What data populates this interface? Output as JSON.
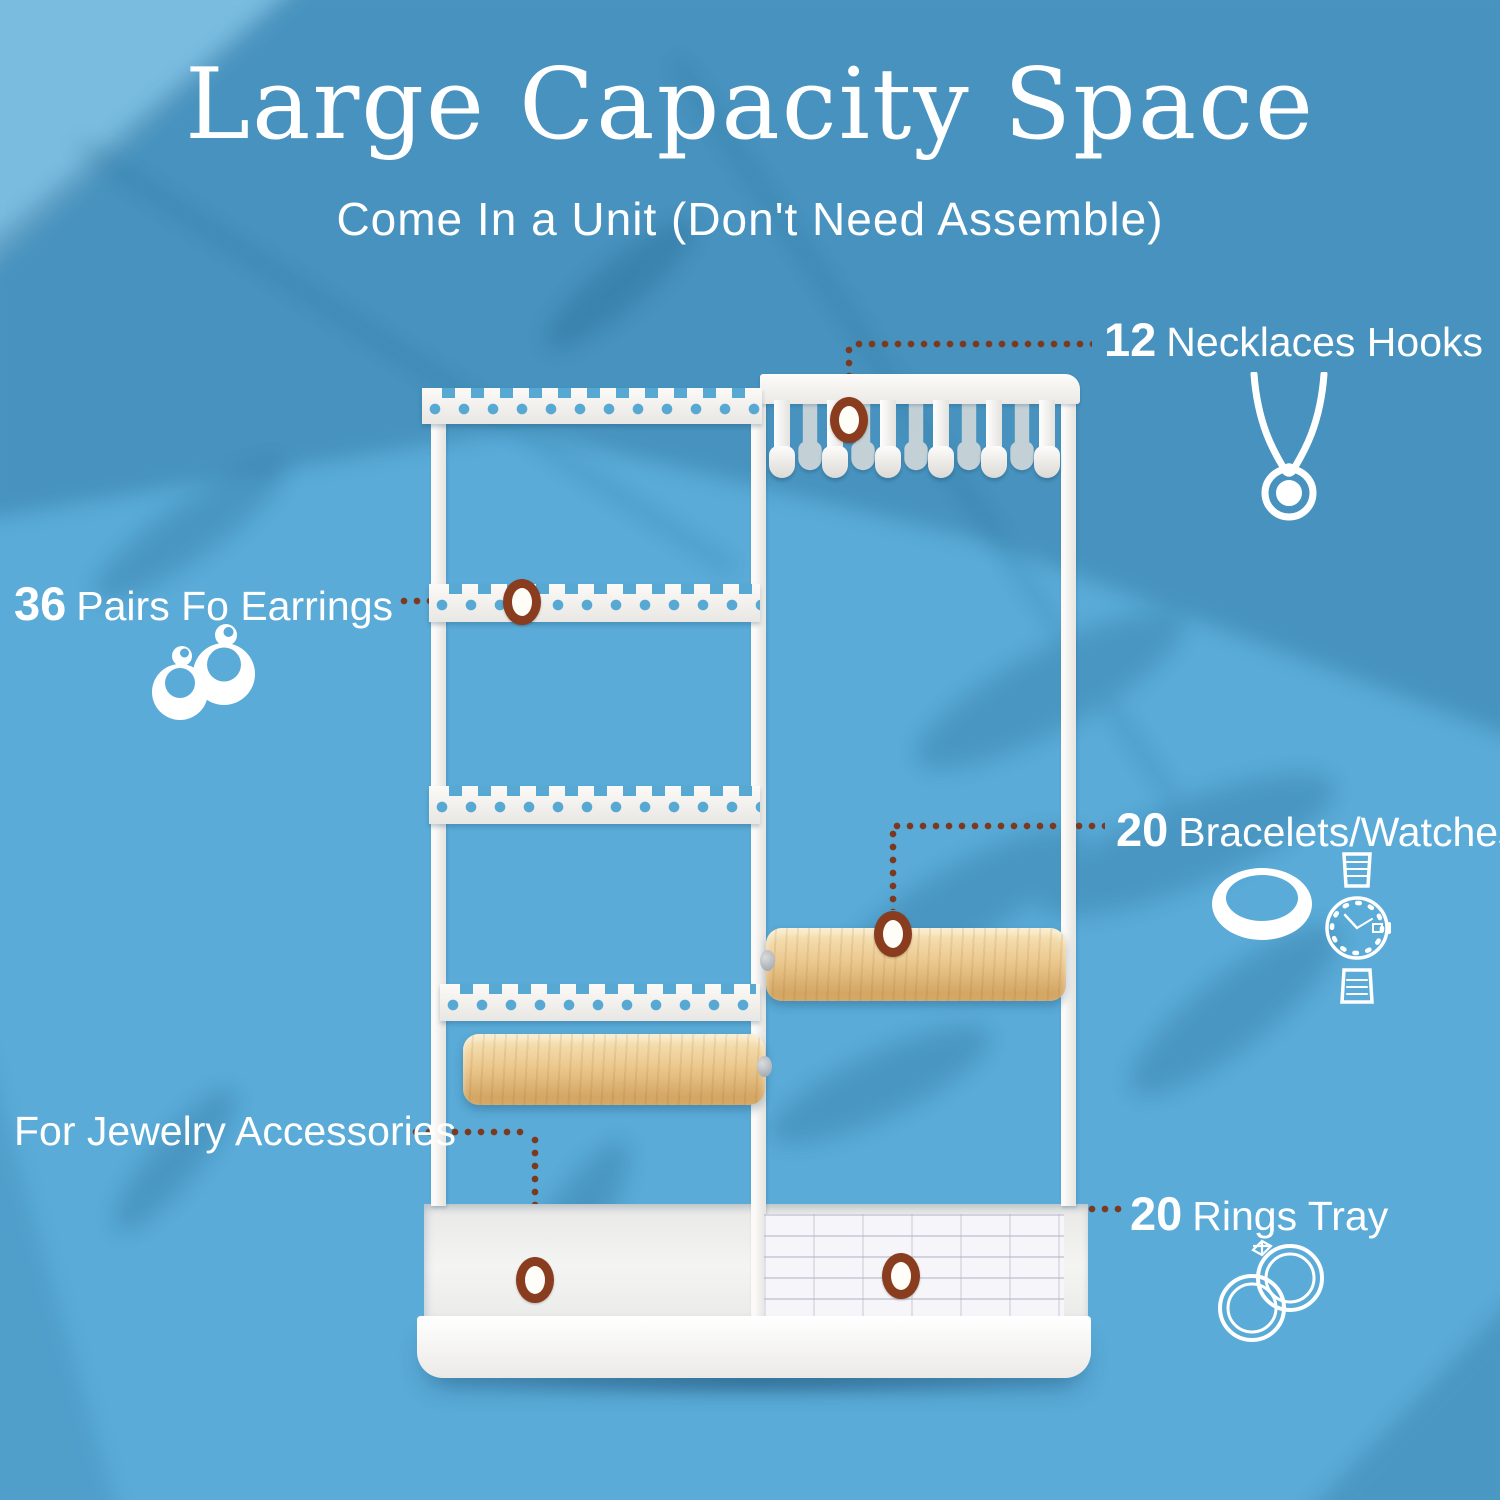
{
  "header": {
    "title": "Large Capacity Space",
    "subtitle": "Come In a Unit (Don't Need Assemble)"
  },
  "callouts": {
    "necklaces": {
      "count": "12",
      "label": "Necklaces Hooks"
    },
    "earrings": {
      "count": "36",
      "label": "Pairs Fo Earrings"
    },
    "bracelets": {
      "count": "20",
      "label": "Bracelets/Watches"
    },
    "accessories": {
      "label": "For Jewelry Accessories"
    },
    "rings": {
      "count": "20",
      "label": "Rings Tray"
    }
  },
  "icons": {
    "necklace": "necklace-icon",
    "earrings": "earrings-icon",
    "bangle": "bangle-icon",
    "watch": "watch-icon",
    "rings": "rings-icon"
  },
  "colors": {
    "background": "#5aabd8",
    "shadow_blue": "#14527c",
    "dotted_line": "#7b3a1f",
    "marker_ring": "#8a3c1e",
    "stand_white": "#f4f3f0",
    "wood_light": "#f6e2b5",
    "wood_dark": "#d4a765",
    "text": "#ffffff"
  }
}
